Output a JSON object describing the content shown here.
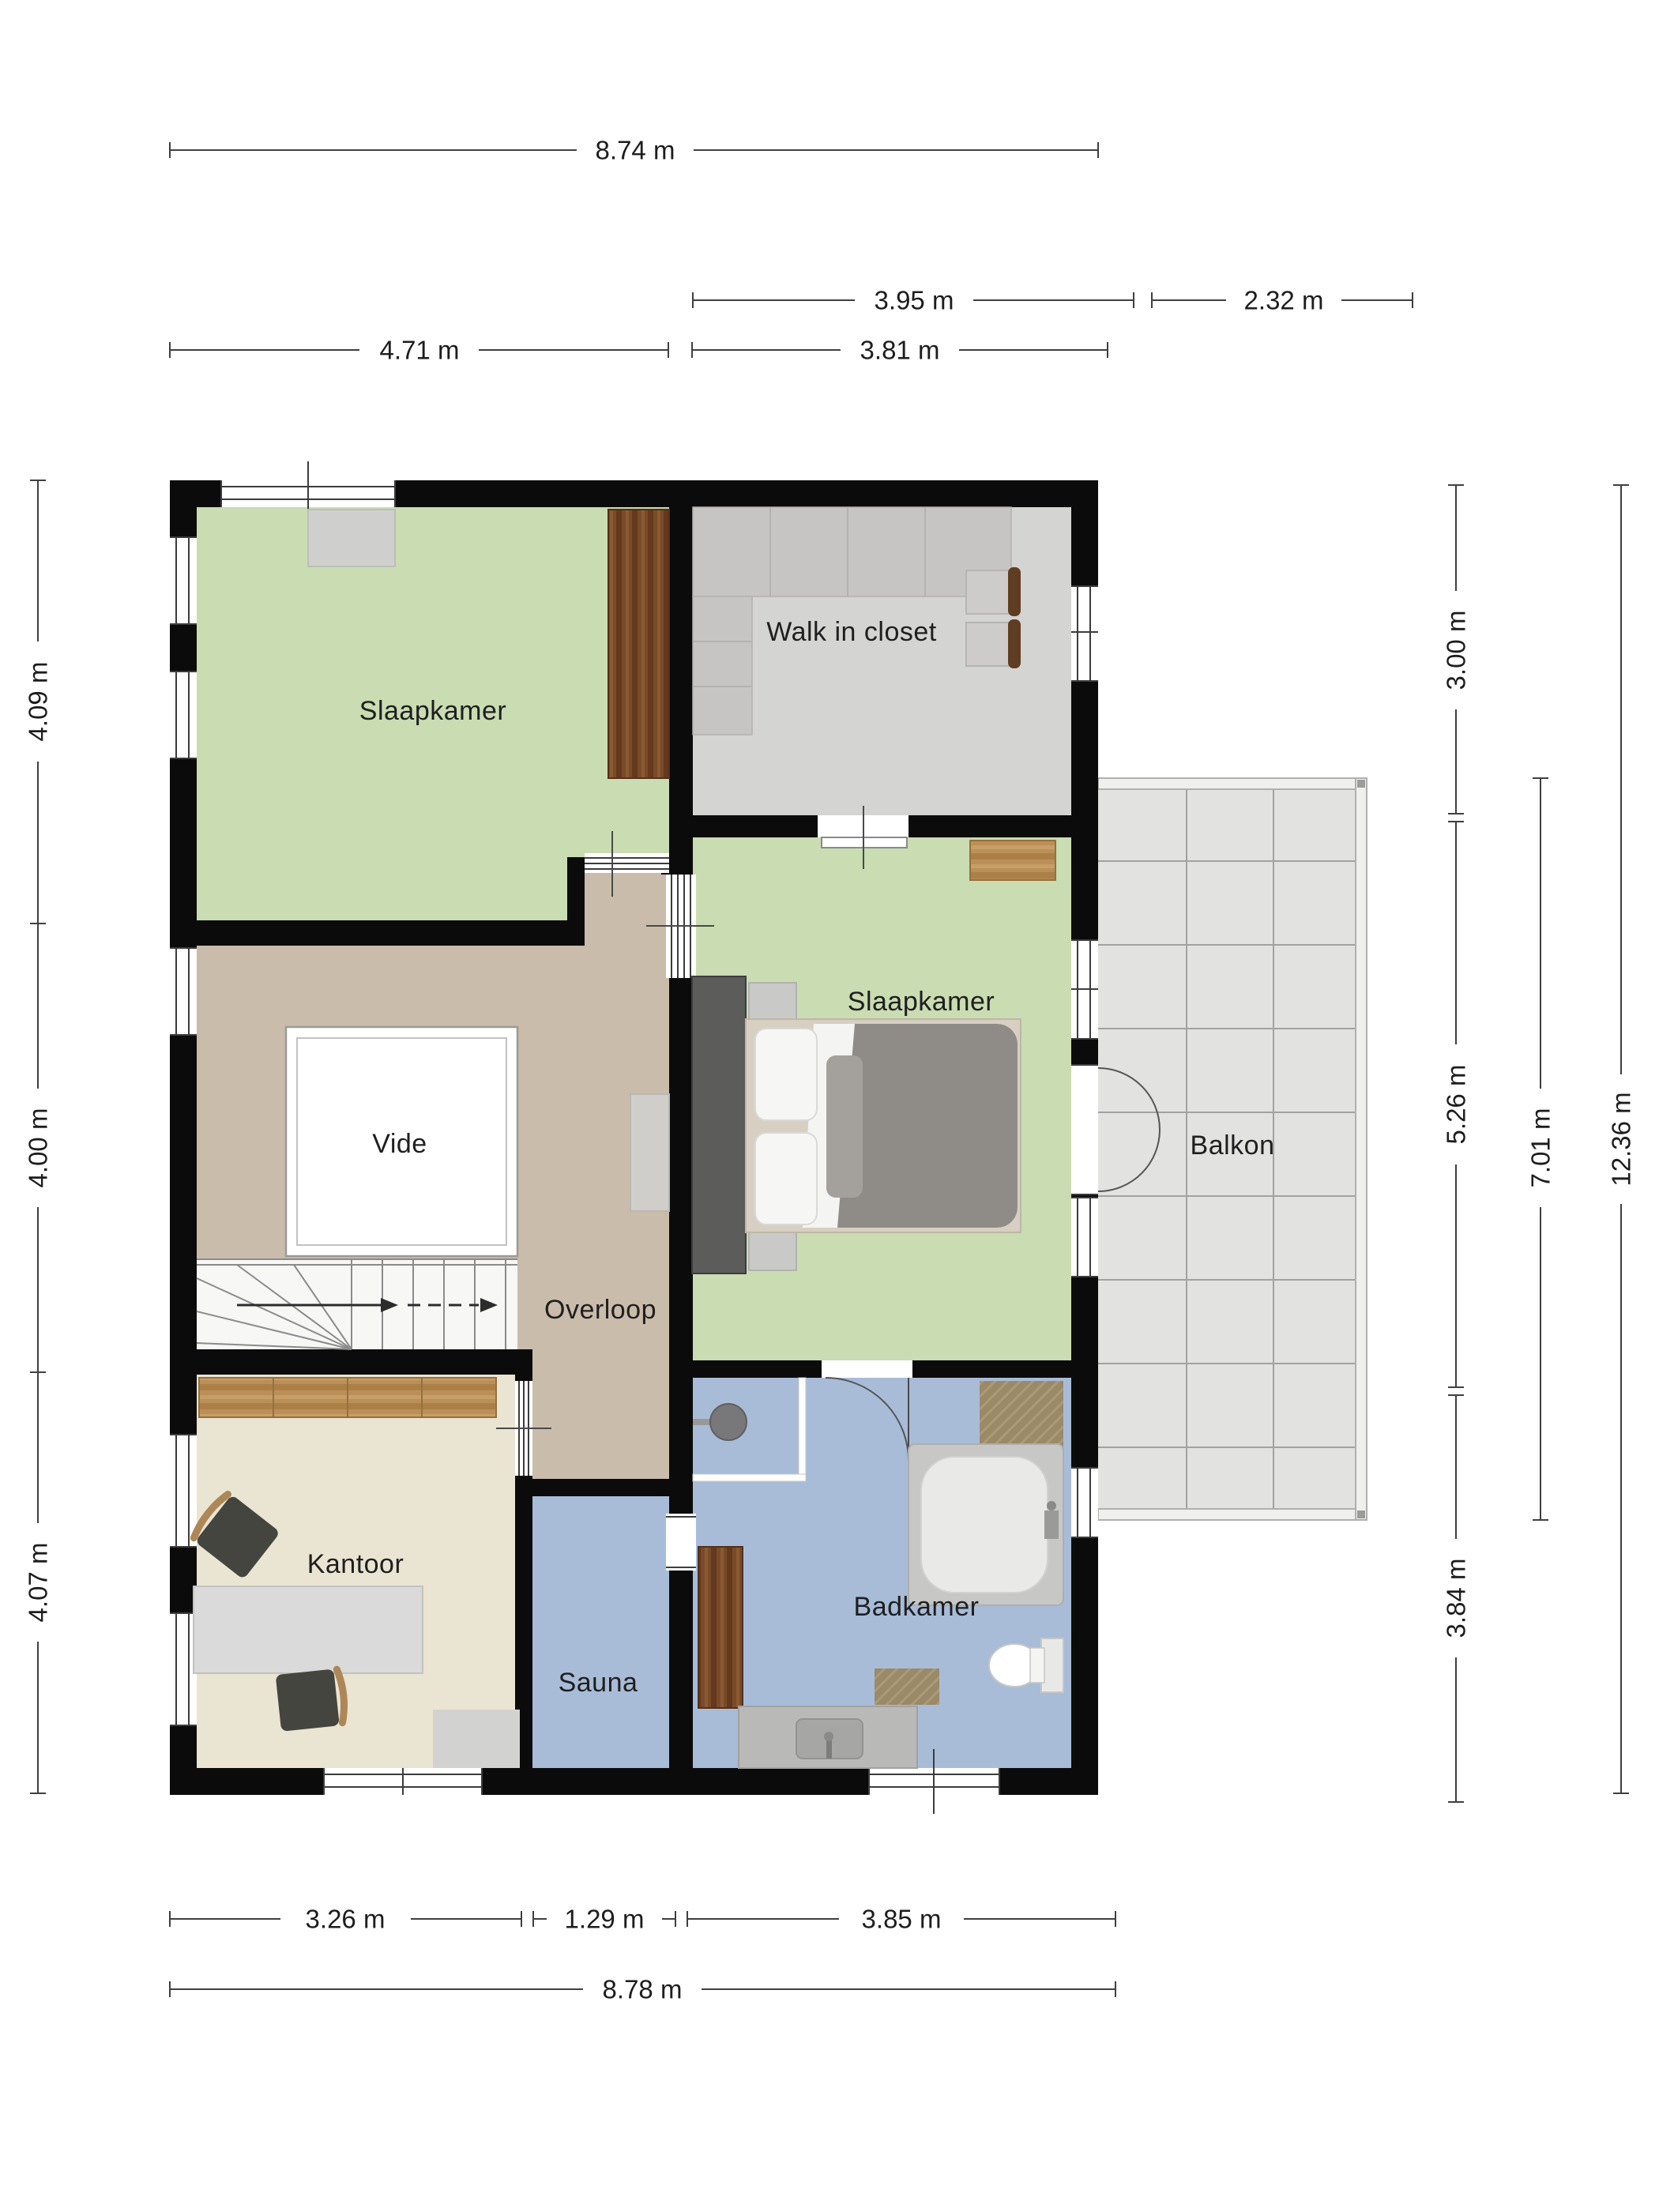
{
  "plan": {
    "type": "floorplan",
    "language": "Dutch",
    "rooms": [
      {
        "id": "slaapkamer-1",
        "label": "Slaapkamer"
      },
      {
        "id": "walk-in-closet",
        "label": "Walk in closet"
      },
      {
        "id": "slaapkamer-2",
        "label": "Slaapkamer"
      },
      {
        "id": "vide",
        "label": "Vide"
      },
      {
        "id": "overloop",
        "label": "Overloop"
      },
      {
        "id": "balkon",
        "label": "Balkon"
      },
      {
        "id": "kantoor",
        "label": "Kantoor"
      },
      {
        "id": "sauna",
        "label": "Sauna"
      },
      {
        "id": "badkamer",
        "label": "Badkamer"
      }
    ],
    "dimensions": {
      "top": [
        "8.74 m",
        "3.95 m",
        "2.32 m",
        "4.71 m",
        "3.81 m"
      ],
      "left": [
        "4.09 m",
        "4.00 m",
        "4.07 m"
      ],
      "right": [
        "3.00 m",
        "5.26 m",
        "3.84 m",
        "7.01 m",
        "12.36 m"
      ],
      "bottom": [
        "3.26 m",
        "1.29 m",
        "3.85 m",
        "8.78 m"
      ]
    },
    "icons": [
      "window-icon",
      "door-swing-icon",
      "sliding-glass-door-icon",
      "stairs-icon",
      "walk-line-arrow-icon",
      "double-bed-icon",
      "wardrobe-icon",
      "closet-unit-icon",
      "stool-icon",
      "desk-icon",
      "office-chair-icon",
      "sideboard-icon",
      "rug-icon",
      "shower-icon",
      "bathtub-icon",
      "toilet-icon",
      "vanity-sink-icon",
      "bath-mat-icon",
      "cabinet-icon",
      "balcony-tiles-icon"
    ]
  },
  "palette": {
    "wall": "#0b0b0b",
    "floor-green": "#c9dcb2",
    "floor-gray": "#d4d4d2",
    "floor-tan": "#c9bcab",
    "floor-cream": "#eae4d2",
    "floor-blue": "#a8bcd8",
    "floor-balcony": "#e2e2e1",
    "closet-unit": "#c6c5c3",
    "wood-dark": "#7a4b28",
    "wood-light": "#bb9058",
    "mat": "#9b8a68",
    "duvet": "#8f8c88",
    "panel-dark": "#5c5c5a",
    "furn-gray": "#d8d8d6",
    "chair-dark": "#45453f",
    "dim-line": "#3f3f3f",
    "dim-ink": "#1d1d1d",
    "ink": "#1f1f1f"
  }
}
